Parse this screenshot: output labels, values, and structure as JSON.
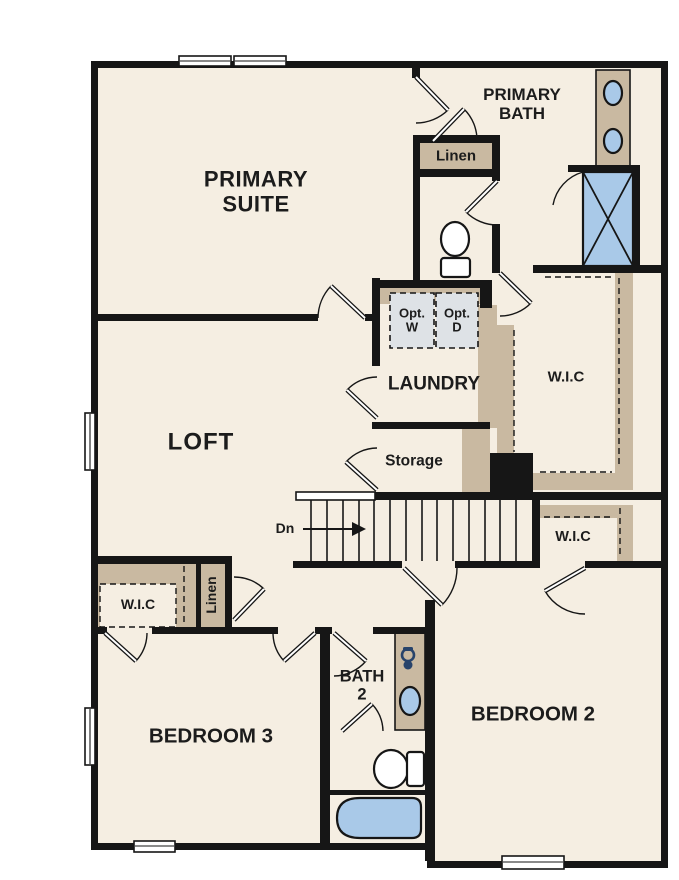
{
  "colors": {
    "wall": "#161616",
    "floor": "#f5eee2",
    "cabinet": "#c9b9a1",
    "fixture_blue": "#a9c9e8",
    "appliance_gray": "#dee2e6",
    "text": "#1c1c1c",
    "accent_navy": "#27436b"
  },
  "rooms": {
    "primary_suite": {
      "line1": "PRIMARY",
      "line2": "SUITE"
    },
    "primary_bath": {
      "line1": "PRIMARY",
      "line2": "BATH"
    },
    "loft": {
      "label": "LOFT"
    },
    "laundry": {
      "label": "LAUNDRY"
    },
    "bedroom2": {
      "label": "BEDROOM 2"
    },
    "bedroom3": {
      "label": "BEDROOM 3"
    },
    "bath2": {
      "line1": "BATH",
      "line2": "2"
    },
    "wic_primary": {
      "label": "W.I.C"
    },
    "wic_hall": {
      "label": "W.I.C"
    },
    "wic_bedroom3": {
      "label": "W.I.C"
    },
    "linen_upper": {
      "label": "Linen"
    },
    "linen_lower": {
      "label": "Linen"
    },
    "storage": {
      "label": "Storage"
    },
    "stairs": {
      "label": "Dn"
    },
    "washer": {
      "line1": "Opt.",
      "line2": "W"
    },
    "dryer": {
      "line1": "Opt.",
      "line2": "D"
    }
  }
}
